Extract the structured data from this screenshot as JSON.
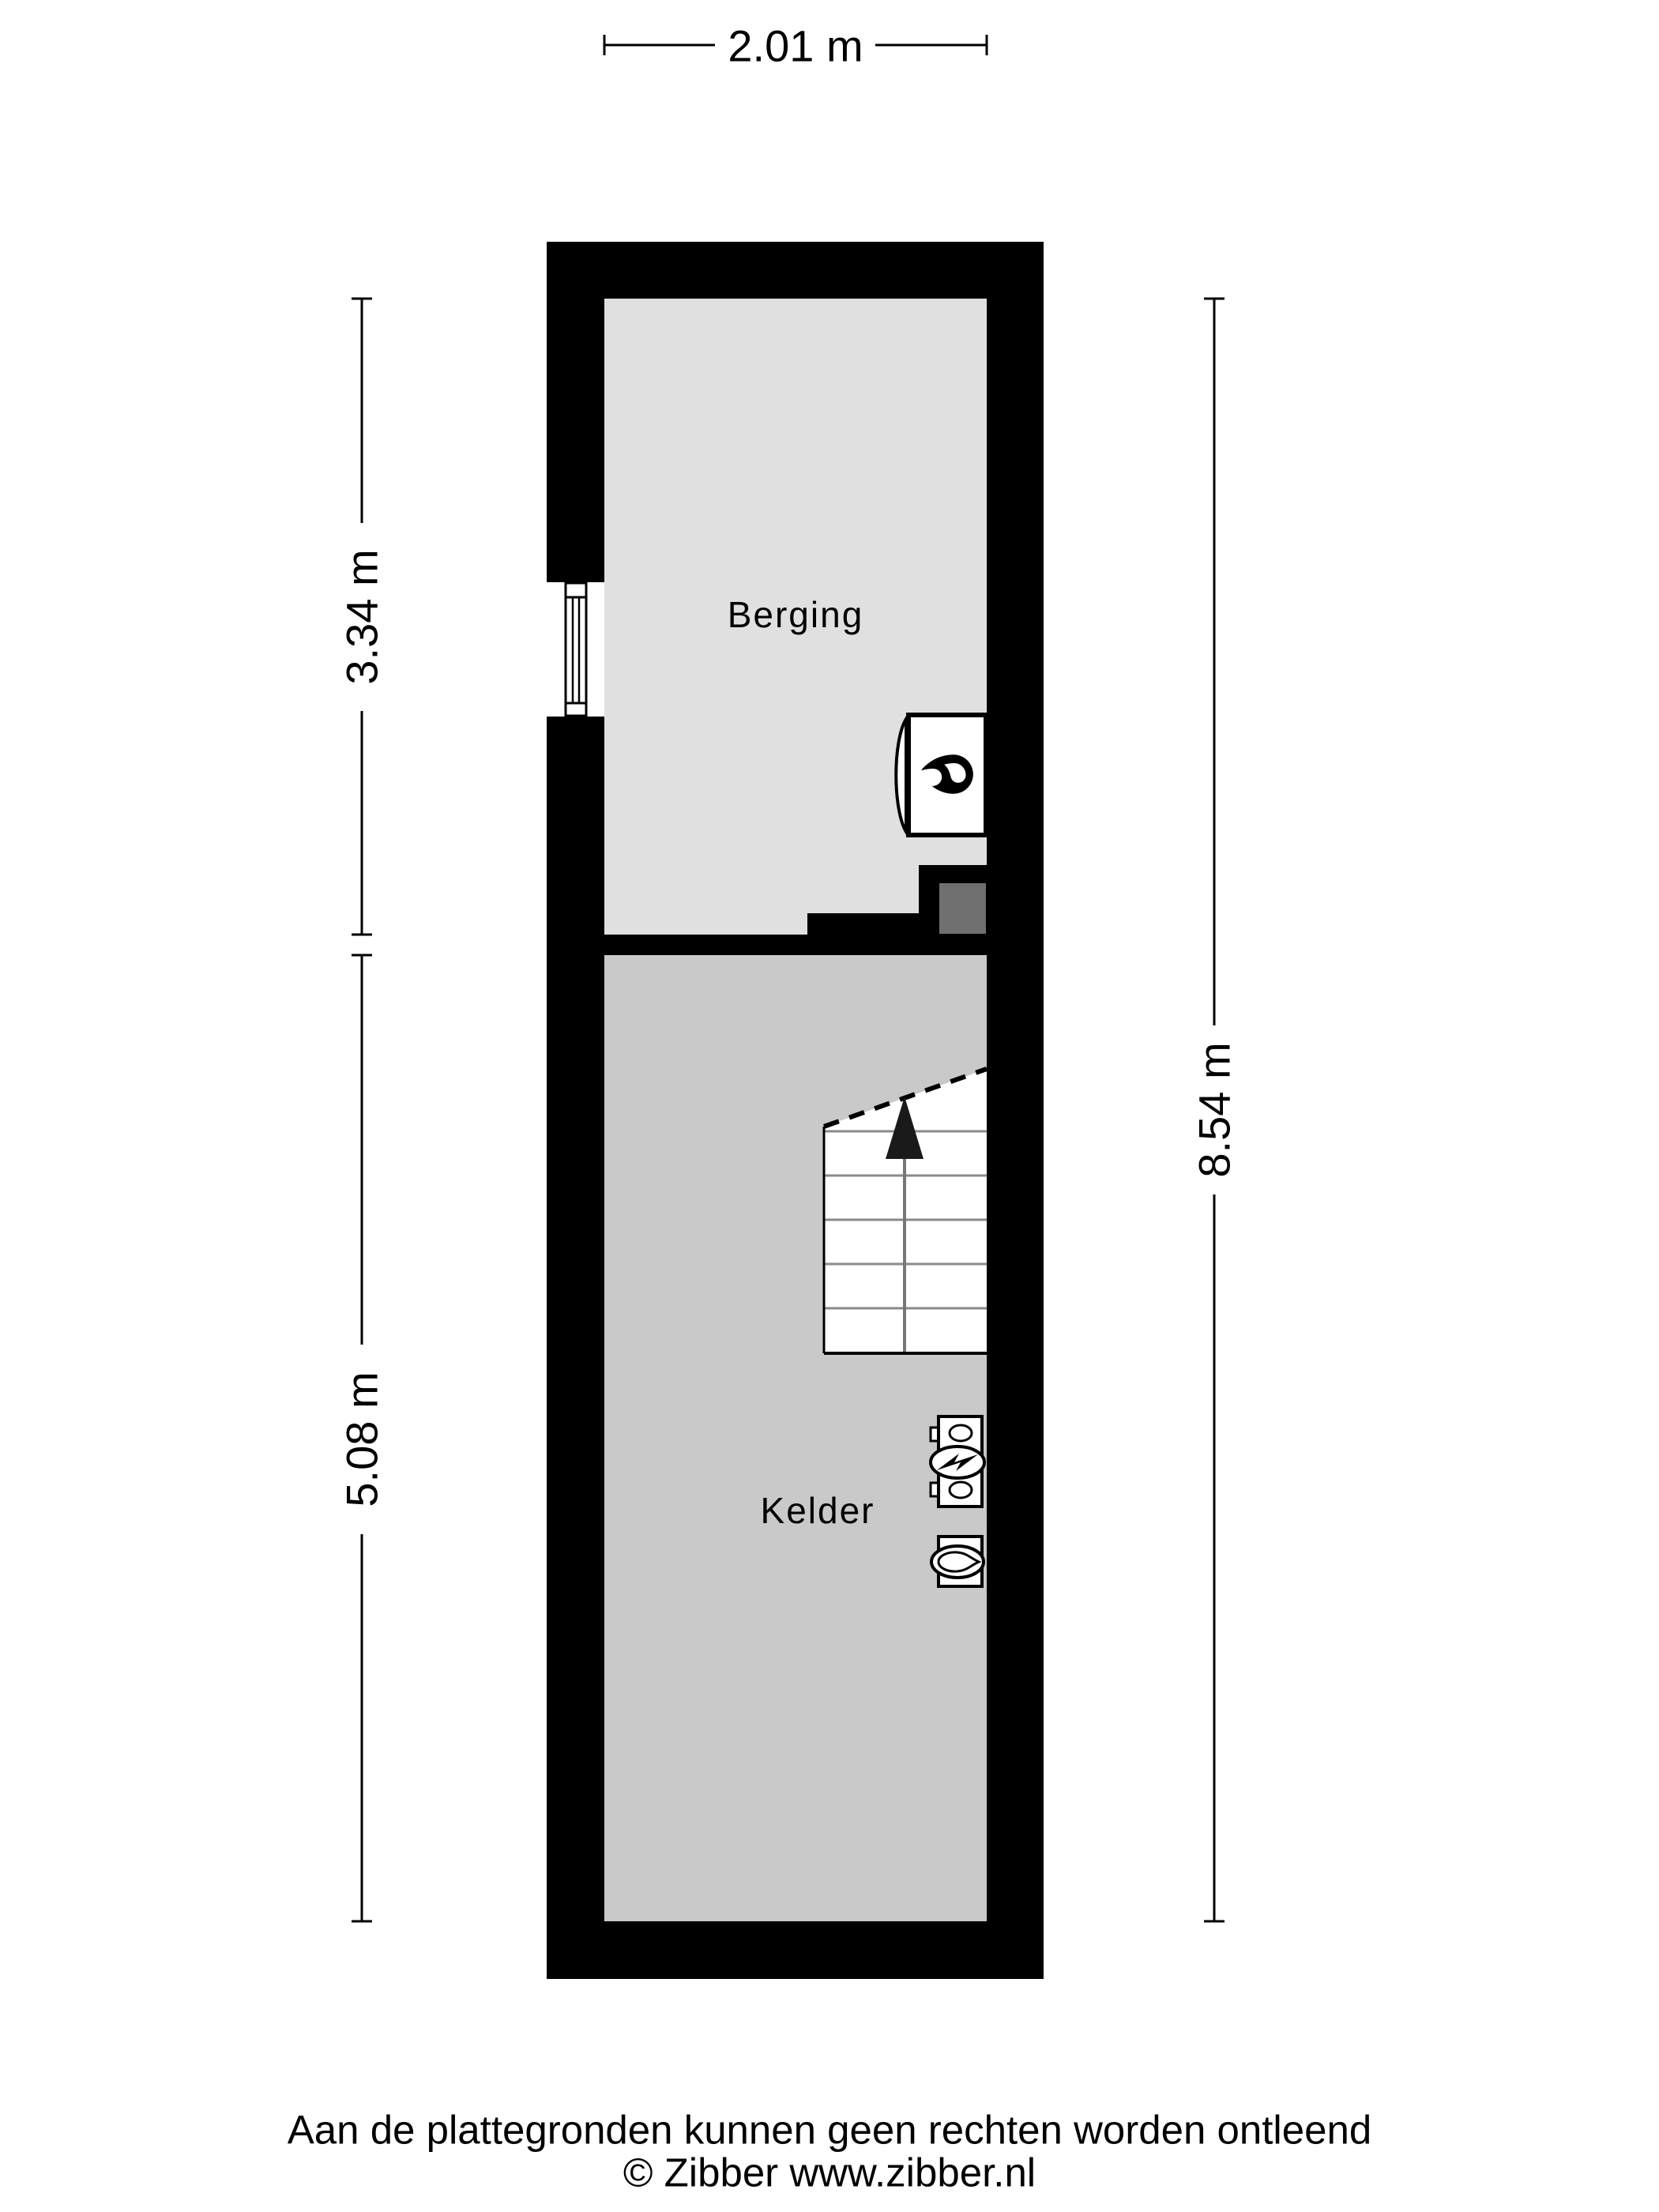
{
  "plan": {
    "type": "floorplan",
    "rooms": [
      {
        "name": "Berging",
        "floor_color": "#e0e0e0"
      },
      {
        "name": "Kelder",
        "floor_color": "#c9c9c9"
      }
    ],
    "dimensions": {
      "top": "2.01 m",
      "left_upper": "3.34 m",
      "left_lower": "5.08 m",
      "right": "8.54 m"
    },
    "icons": {
      "boiler": "boiler-flame-icon",
      "window": "window-symbol-icon",
      "stairs_direction": "stairs-up-arrow-icon",
      "electric_meter": "electric-meter-icon",
      "gas_meter": "gas-meter-icon"
    },
    "colors": {
      "background": "#ffffff",
      "wall": "#000000",
      "berging_floor": "#e0e0e0",
      "kelder_floor": "#c9c9c9",
      "step": "#6f6f6f",
      "stair_tread_line": "#8a8a8a",
      "text": "#000000"
    }
  },
  "footer": {
    "disclaimer": "Aan de plattegronden kunnen geen rechten worden ontleend",
    "copyright": "© Zibber www.zibber.nl"
  }
}
